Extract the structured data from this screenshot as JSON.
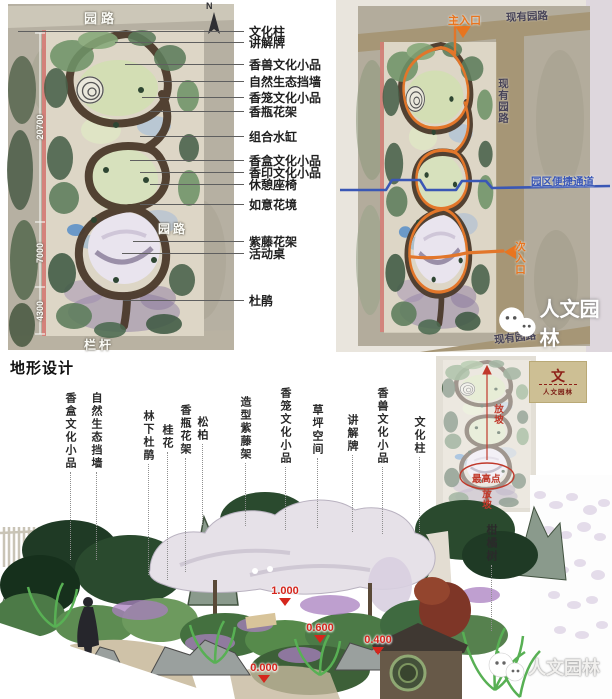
{
  "colors": {
    "accent_orange": "#e8751f",
    "route_blue": "#3a57b5",
    "annotation_red": "#c0392b",
    "elevation_red": "#d5261d",
    "logo_bg": "#cdbf94",
    "logo_red": "#8d1f17"
  },
  "left_plan": {
    "road_top": "园路",
    "road_mid": "园路",
    "railing": "栏杆",
    "north": "N",
    "dims": [
      "20700",
      "7000",
      "4300"
    ],
    "callouts": [
      "文化柱",
      "讲解牌",
      "香兽文化小品",
      "自然生态挡墙",
      "香笼文化小品",
      "香瓶花架",
      "组合水缸",
      "香盒文化小品",
      "香印文化小品",
      "休憩座椅",
      "如意花境",
      "紫藤花架",
      "活动桌",
      "杜鹃"
    ]
  },
  "right_plan": {
    "main_entrance": "主入口",
    "secondary_entrance": "次入口",
    "existing_road_top": "现有园路",
    "existing_road_right": "现有园路",
    "existing_road_bottom": "现有园路",
    "shortcut_channel": "园区便捷通道",
    "watermark": "人文园林"
  },
  "terrain": {
    "title": "地形设计",
    "labels": [
      "香盒文化小品",
      "自然生态挡墙",
      "林下杜鹃",
      "桂花",
      "香瓶花架",
      "松柏",
      "造型紫藤架",
      "香笼文化小品",
      "草坪空间",
      "讲解牌",
      "香兽文化小品",
      "文化柱",
      "柑橘树"
    ],
    "inset": {
      "slope_top": "放坡",
      "highest_point": "最高点",
      "slope_bottom": "放坡"
    },
    "logo": {
      "symbol": "文",
      "name": "人文园林"
    },
    "elevations": [
      "1.000",
      "0.600",
      "0.400",
      "0.000"
    ],
    "watermark": "人文园林"
  }
}
